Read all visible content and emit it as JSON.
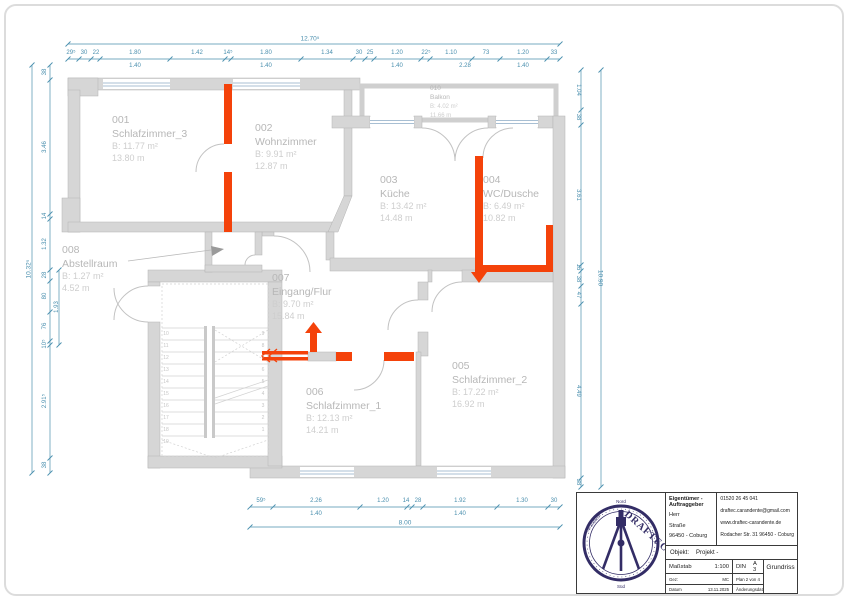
{
  "colors": {
    "highlight": "#f4420a",
    "dimension": "#4a8fae",
    "wall": "#d6d6d6",
    "logo_navy": "#332d66"
  },
  "rooms": [
    {
      "number": "001",
      "name": "Schlafzimmer_3",
      "area": "B:  11.77  m²",
      "perimeter": "13.80  m"
    },
    {
      "number": "002",
      "name": "Wohnzimmer",
      "area": "B:  9.91  m²",
      "perimeter": "12.87  m"
    },
    {
      "number": "003",
      "name": "Küche",
      "area": "B:  13.42  m²",
      "perimeter": "14.48  m"
    },
    {
      "number": "004",
      "name": "WC/Dusche",
      "area": "B:  6.49  m²",
      "perimeter": "10.82  m"
    },
    {
      "number": "005",
      "name": "Schlafzimmer_2",
      "area": "B:  17.22  m²",
      "perimeter": "16.92  m"
    },
    {
      "number": "006",
      "name": "Schlafzimmer_1",
      "area": "B:  12.13  m²",
      "perimeter": "14.21  m"
    },
    {
      "number": "007",
      "name": "Eingang/Flur",
      "area": "B:  9.70  m²",
      "perimeter": "15.84  m"
    },
    {
      "number": "008",
      "name": "Abstellraum",
      "area": "B:  1.27  m²",
      "perimeter": "4.52  m"
    },
    {
      "number": "010",
      "name": "Balkon",
      "area": "B:  4.02  m²",
      "perimeter": "11.66  m"
    }
  ],
  "dims": {
    "top_total": "12.70⁵",
    "top_row1": [
      "29⁵",
      "30",
      "22",
      "1.80",
      "1.42",
      "14⁵",
      "1.80",
      "1.34",
      "30",
      "25",
      "1.20",
      "22⁵",
      "1.10",
      "73",
      "1.20",
      "33"
    ],
    "top_row2": [
      "1.40",
      "1.40",
      "1.40",
      "2.28",
      "1.40"
    ],
    "left_total": "10.32⁵",
    "left_row": [
      "38",
      "3.46",
      "14",
      "1.32",
      "28",
      "80",
      "76",
      "10⁵",
      "2.91⁵",
      "38"
    ],
    "left_sub": "1.93",
    "right_total": "10.90",
    "right_row": [
      "1.04",
      "38",
      "3.61",
      "15",
      "38",
      "47",
      "4.49",
      "38"
    ],
    "bottom_row1": [
      "59⁵",
      "2.26",
      "1.20",
      "14",
      "28",
      "1.92",
      "1.30",
      "30"
    ],
    "bottom_row2": [
      "1.40",
      "1.40"
    ],
    "bottom_total": "8.00"
  },
  "stairs": {
    "left": [
      "10",
      "11",
      "12",
      "13",
      "14",
      "15",
      "16",
      "17",
      "18",
      "19"
    ],
    "right": [
      "9",
      "8",
      "7",
      "6",
      "5",
      "4",
      "3",
      "2",
      "1"
    ]
  },
  "title_block": {
    "owner_header": "Eigentümer - Auftraggeber",
    "owner_line1": "Herr",
    "owner_line2": "Straße",
    "owner_line3": "96450 - Coburg",
    "phone": "01520 26 45 041",
    "email": "draftec.carandente@gmail.com",
    "website": "www.draftec-carandente.de",
    "address": "Rodacher Str. 31 96450 - Coburg",
    "objekt_label": "Objekt:",
    "objekt_value": "Projekt -",
    "massstab_label": "Maßstab",
    "massstab_value": "1:100",
    "din_label": "DIN",
    "din_value": "A 3",
    "drawing_name": "Grundriss",
    "gez_label": "Gez:",
    "gez_value": "MC",
    "plan_info": "Plan  2  von  4",
    "datum_label": "Datum",
    "datum_value": "13.11.2025",
    "change_label": "Änderungsdatum",
    "logo": {
      "brand": "DRAFTEC",
      "top": "Nord",
      "bottom": "Süd",
      "side": "Carandente"
    }
  }
}
